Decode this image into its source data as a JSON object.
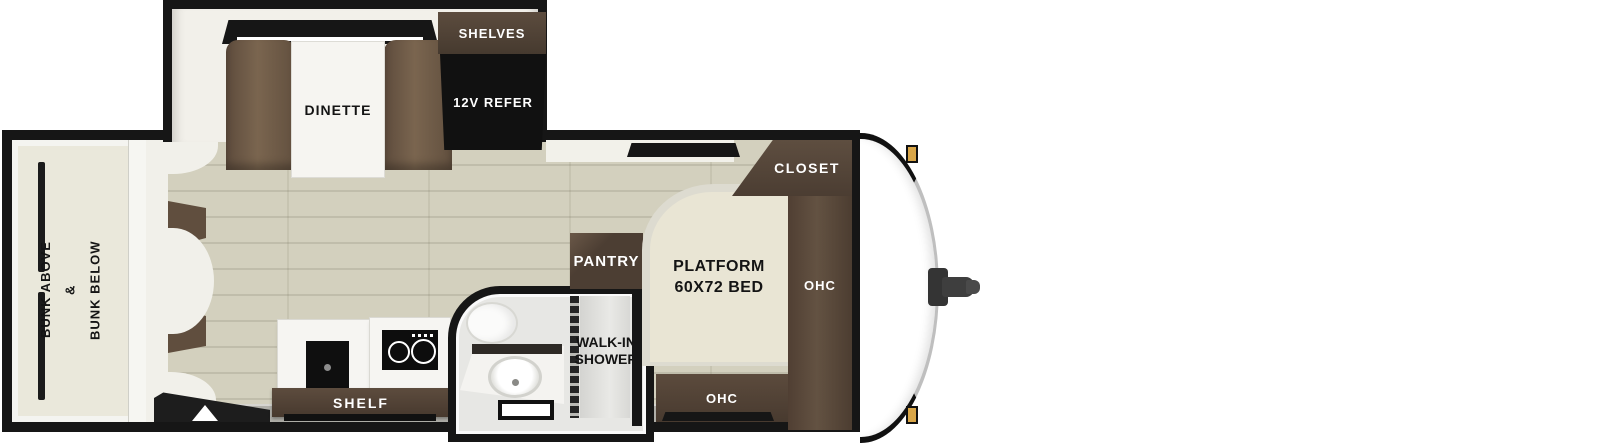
{
  "floorplan": {
    "type": "travel-trailer-floorplan",
    "labels": {
      "dinette": "DINETTE",
      "shelves": "SHELVES",
      "refer": "12V REFER",
      "bunk_line1": "BUNK ABOVE",
      "bunk_line2": "&",
      "bunk_line3": "BUNK BELOW",
      "shelf": "SHELF",
      "pantry": "PANTRY",
      "shower_line1": "WALK-IN",
      "shower_line2": "SHOWER",
      "bed_line1": "PLATFORM",
      "bed_line2": "60X72 BED",
      "closet": "CLOSET",
      "ohc_side": "OHC",
      "ohc_foot": "OHC"
    },
    "colors": {
      "wall_black": "#161616",
      "wood_dark": "#554538",
      "bench_brown": "#6e5a47",
      "floor_plank": "#d3d0be",
      "floor_seam": "#c0bdab",
      "bunk_cream": "#eae8db",
      "bed_cream": "#e9e5d4",
      "white_surface": "#f2f0ea",
      "appliance_black": "#111111",
      "gray_strip": "#b0afa9",
      "bath_gray": "#e7e7e4",
      "amber": "#d9a648"
    }
  }
}
